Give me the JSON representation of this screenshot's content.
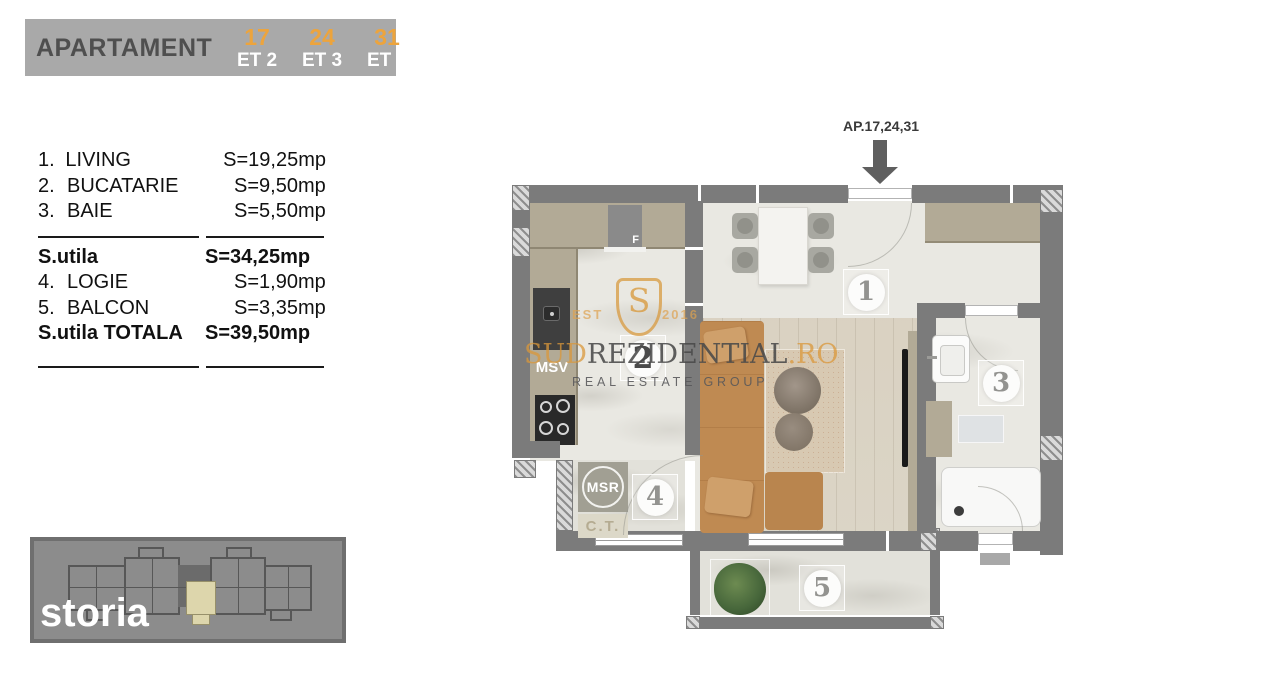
{
  "header": {
    "title": "APARTAMENT",
    "units": [
      {
        "number": "17",
        "floor": "ET 2"
      },
      {
        "number": "24",
        "floor": "ET 3"
      },
      {
        "number": "31",
        "floor": "ET 4"
      }
    ]
  },
  "room_list": {
    "rows": [
      {
        "num": "1.",
        "name": "LIVING",
        "area": "S=19,25mp"
      },
      {
        "num": "2.",
        "name": "BUCATARIE",
        "area": "S=9,50mp"
      },
      {
        "num": "3.",
        "name": "BAIE",
        "area": "S=5,50mp"
      },
      {
        "num": "",
        "name": "S.utila",
        "area": "S=34,25mp"
      },
      {
        "num": "4.",
        "name": "LOGIE",
        "area": "S=1,90mp"
      },
      {
        "num": "5.",
        "name": "BALCON",
        "area": "S=3,35mp"
      },
      {
        "num": "",
        "name": "S.utila TOTALA",
        "area": "S=39,50mp"
      }
    ]
  },
  "floor_plan": {
    "pointer_label": "AP.17,24,31",
    "room_badges": [
      {
        "room": "living",
        "number": "1"
      },
      {
        "room": "bucatarie",
        "number": "2"
      },
      {
        "room": "baie",
        "number": "3"
      },
      {
        "room": "logie",
        "number": "4"
      },
      {
        "room": "balcon",
        "number": "5"
      }
    ],
    "equipment_labels": {
      "fridge": "F",
      "dishwasher": "MSV",
      "washing_machine": "MSR",
      "boiler": "C.T."
    }
  },
  "watermark": {
    "est": "EST",
    "year": "2016",
    "logo_letter": "S",
    "brand_left": "SUD",
    "brand_main": "REZIDENTIAL",
    "brand_right": ".RO",
    "tagline": "REAL ESTATE GROUP"
  },
  "mini_plan": {
    "watermark": "storia"
  },
  "colors": {
    "accent_orange": "#EDA43C",
    "header_gray": "#A9A9A9",
    "wall_gray": "#7B7B7B",
    "counter_taupe": "#B2AA96",
    "sofa_tan": "#BF8A52",
    "unit_highlight": "#DDD6AC",
    "plant_green": "#47673B",
    "watermark_orange": "#D89A3F"
  }
}
